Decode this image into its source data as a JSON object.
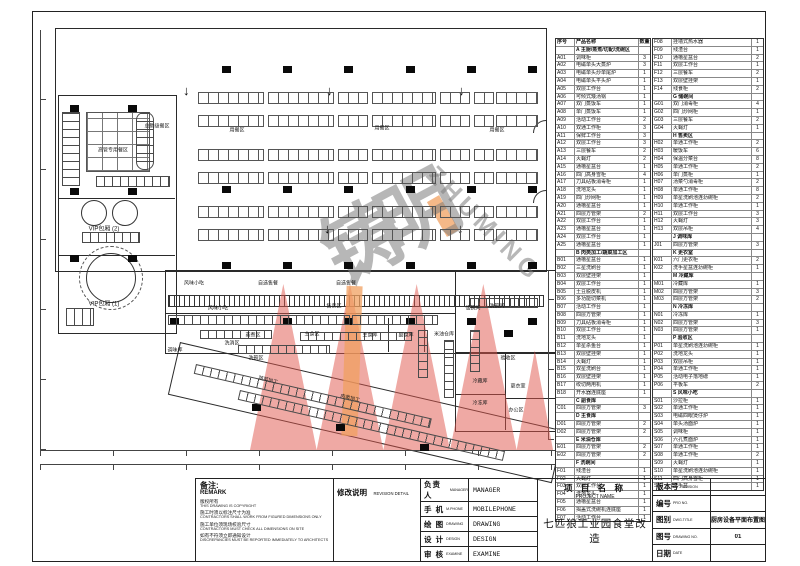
{
  "sheet": {
    "remark": {
      "title": "备注:",
      "subtitle": "REMARK",
      "lines": [
        [
          "版权所有",
          "THIS DRAWING IS COPYRIGHT"
        ],
        [
          "施工时须以标注尺寸为准",
          "CONTRACTORS SHALL WORK FROM FIGURED DIMENSIONS ONLY"
        ],
        [
          "施工单位须现场校验尺寸",
          "CONTRACTORS MUST CHECK ALL DIMENSIONS ON SITE"
        ],
        [
          "如有不符须立即通知设计",
          "DISCREPANCIES MUST BE REPORTED IMMEDIATELY TO ARCHITECTS"
        ]
      ]
    },
    "revision": {
      "label": "修改说明",
      "label_en": "REVISION DETAIL"
    },
    "signoff": [
      [
        "负责人",
        "MANAGER",
        "MANAGER"
      ],
      [
        "手 机",
        "M.PHONE",
        "MOBILEPHONE"
      ],
      [
        "绘 图",
        "DRAWING",
        "DRAWING"
      ],
      [
        "设 计",
        "DESIGN",
        "DESIGN"
      ],
      [
        "审 核",
        "EXAMINE",
        "EXAMINE"
      ]
    ],
    "project": {
      "label": "项 目 名 称",
      "label_en": "PROJECT NAME",
      "name": "七匹狼工业园食堂改造"
    },
    "info": [
      [
        "版本号",
        "REVISION",
        ""
      ],
      [
        "编号",
        "PRO NO.",
        ""
      ],
      [
        "图别",
        "DWG.TITLE",
        "厨房设备平面布置图"
      ],
      [
        "图号",
        "DRAWING NO.",
        "01"
      ],
      [
        "日期",
        "DATE",
        ""
      ]
    ]
  },
  "equipment": {
    "headers": [
      "序号",
      "产品名称",
      "数量"
    ],
    "left": [
      {
        "s": "A 主厨/蒸煮/切配/洗碗区"
      },
      [
        "A01",
        "调味柜",
        "3"
      ],
      [
        "A02",
        "电磁单头大蒸炉",
        "3"
      ],
      [
        "A03",
        "电磁单头炒单尾炉",
        "1"
      ],
      [
        "A04",
        "电磁单头平头炉",
        "1"
      ],
      [
        "A05",
        "双层工作台",
        "1"
      ],
      [
        "A06",
        "可倾式矮汤锅",
        "1"
      ],
      [
        "A07",
        "双门蒸饭车",
        "1"
      ],
      [
        "A08",
        "单门蒸饭车",
        "1"
      ],
      [
        "A09",
        "活动工作台",
        "2"
      ],
      [
        "A10",
        "双通工作柜",
        "3"
      ],
      [
        "A11",
        "保鲜工作台",
        "3"
      ],
      [
        "A12",
        "双层工作台",
        "3"
      ],
      [
        "A13",
        "三层餐车",
        "2"
      ],
      [
        "A14",
        "灭蝇灯",
        "2"
      ],
      [
        "A15",
        "通槽星盆台",
        "1"
      ],
      [
        "A16",
        "四门高身雪柜",
        "4"
      ],
      [
        "A17",
        "刀具砧板消毒柜",
        "1"
      ],
      [
        "A18",
        "洗地龙头",
        "1"
      ],
      [
        "A19",
        "四门炒网柜",
        "1"
      ],
      [
        "A20",
        "通槽星盆台",
        "1"
      ],
      [
        "A21",
        "四层方管架",
        "2"
      ],
      [
        "A22",
        "双层工作台",
        "1"
      ],
      [
        "A23",
        "通槽星盆台",
        "1"
      ],
      [
        "A24",
        "双层工作台",
        "1"
      ],
      [
        "A25",
        "通槽星盆台",
        "1"
      ],
      {
        "s": "B 肉类加工/蔬菜加工区"
      },
      [
        "B01",
        "通槽星盆台",
        "1"
      ],
      [
        "B02",
        "三星洗刷台",
        "1"
      ],
      [
        "B03",
        "双层壁挂架",
        "1"
      ],
      [
        "B04",
        "双层工作台",
        "1"
      ],
      [
        "B05",
        "土豆脱皮机",
        "1"
      ],
      [
        "B06",
        "多功能切菜机",
        "1"
      ],
      [
        "B07",
        "活动工作台",
        "1"
      ],
      [
        "B08",
        "四层方管架",
        "1"
      ],
      [
        "B09",
        "刀具砧板消毒柜",
        "1"
      ],
      [
        "B10",
        "双层工作台",
        "1"
      ],
      [
        "B11",
        "洗地龙头",
        "1"
      ],
      [
        "B12",
        "单星杀鱼台",
        "1"
      ],
      [
        "B13",
        "双层壁挂架",
        "1"
      ],
      [
        "B14",
        "灭蝇灯",
        "1"
      ],
      [
        "B15",
        "双星洗刷台",
        "1"
      ],
      [
        "B16",
        "双层壁挂架",
        "1"
      ],
      [
        "B17",
        "绞切两用机",
        "1"
      ],
      [
        "B18",
        "开水器连底座",
        "1"
      ],
      {
        "s": "C 副食库"
      },
      [
        "C01",
        "四层方管架",
        "3"
      ],
      {
        "s": "D 主食库"
      },
      [
        "D01",
        "四层方管架",
        "2"
      ],
      [
        "D02",
        "四层方管架",
        "2"
      ],
      {
        "s": "E 米油仓库"
      },
      [
        "E01",
        "四层方管架",
        "2"
      ],
      [
        "E02",
        "四层方管架",
        "2"
      ],
      {
        "s": "F 洗碗间"
      },
      [
        "F01",
        "残渣台",
        "1"
      ],
      [
        "F02",
        "灭蝇灯",
        "1"
      ],
      [
        "F03",
        "双层工作台",
        "1"
      ],
      [
        "F04",
        "洗地龙头",
        "1"
      ],
      [
        "F05",
        "通槽星盆台",
        "1"
      ],
      [
        "F06",
        "揭盖式洗碗机连底座",
        "1"
      ],
      [
        "F07",
        "活动工作台",
        "1"
      ]
    ],
    "right": [
      [
        "F08",
        "挂墙式热水器",
        "1"
      ],
      [
        "F09",
        "残渣台",
        "1"
      ],
      [
        "F10",
        "通槽星盆台",
        "2"
      ],
      [
        "F11",
        "双层工作台",
        "1"
      ],
      [
        "F12",
        "三层餐车",
        "2"
      ],
      [
        "F13",
        "双层壁挂架",
        "1"
      ],
      [
        "F14",
        "残食柜",
        "2"
      ],
      {
        "s": "G 储碗间"
      },
      [
        "G01",
        "双门消毒柜",
        "4"
      ],
      [
        "G02",
        "四门炒网柜",
        "1"
      ],
      [
        "G03",
        "三层餐车",
        "2"
      ],
      [
        "G04",
        "灭蝇灯",
        "1"
      ],
      {
        "s": "H 售卖区"
      },
      [
        "H02",
        "单通工作柜",
        "2"
      ],
      [
        "H03",
        "暖饭车",
        "6"
      ],
      [
        "H04",
        "保温分菜台",
        "8"
      ],
      [
        "H05",
        "单通工作柜",
        "2"
      ],
      [
        "H06",
        "单门蒸柜",
        "1"
      ],
      [
        "H07",
        "汤菜勺消毒柜",
        "2"
      ],
      [
        "H08",
        "单通工作柜",
        "8"
      ],
      [
        "H09",
        "单星洗刷池连沥碗柜",
        "2"
      ],
      [
        "H10",
        "单通工作柜",
        "1"
      ],
      [
        "H11",
        "双层工作台",
        "3"
      ],
      [
        "H12",
        "灭蝇灯",
        "3"
      ],
      [
        "H13",
        "双层吊柜",
        "4"
      ],
      {
        "s": "J 调味库"
      },
      [
        "J01",
        "四层方管架",
        "3"
      ],
      {
        "s": "K 更衣室"
      },
      [
        "K01",
        "六门更衣柜",
        "2"
      ],
      [
        "K02",
        "洗手星盆连沥碗柜",
        "1"
      ],
      {
        "s": "M 冷藏库"
      },
      [
        "M01",
        "冷藏库",
        "1"
      ],
      [
        "M02",
        "四层方管架",
        "3"
      ],
      [
        "M03",
        "四层方管架",
        "2"
      ],
      {
        "s": "N 冷冻库"
      },
      [
        "N01",
        "冷冻库",
        "1"
      ],
      [
        "N02",
        "四层方管架",
        "3"
      ],
      [
        "N03",
        "四层方管架",
        "1"
      ],
      {
        "s": "P 验收区"
      },
      [
        "P01",
        "单星洗刷池连沥碗柜",
        "1"
      ],
      [
        "P02",
        "洗地龙头",
        "1"
      ],
      [
        "P03",
        "双层吊柜",
        "1"
      ],
      [
        "P04",
        "单通工作柜",
        "1"
      ],
      [
        "P05",
        "活动电子落地磅",
        "1"
      ],
      [
        "P06",
        "平板车",
        "2"
      ],
      {
        "s": "S 风味小吃"
      },
      [
        "S01",
        "沙拉柜",
        "1"
      ],
      [
        "S02",
        "单通工作柜",
        "1"
      ],
      [
        "S03",
        "电磁四眼煲仔炉",
        "1"
      ],
      [
        "S04",
        "单头汤面炉",
        "1"
      ],
      [
        "S05",
        "调味柜",
        "1"
      ],
      [
        "S06",
        "六孔煮面炉",
        "1"
      ],
      [
        "S07",
        "单通工作柜",
        "1"
      ],
      [
        "S08",
        "单通工作柜",
        "2"
      ],
      [
        "S09",
        "灭蝇灯",
        "1"
      ],
      [
        "S10",
        "单星洗刷池连沥碗柜",
        "1"
      ],
      [
        "S11",
        "四门高身雪柜",
        "1"
      ],
      [
        "S12",
        "洗手盆",
        "1"
      ]
    ]
  },
  "plan": {
    "arrow_glyph": "↓",
    "labels": [
      {
        "t": "用餐区",
        "x": 237,
        "y": 131
      },
      {
        "t": "用餐区",
        "x": 382,
        "y": 129
      },
      {
        "t": "用餐区",
        "x": 497,
        "y": 131
      },
      {
        "t": "总助级餐区",
        "x": 157,
        "y": 127
      },
      {
        "t": "高管专用餐区",
        "x": 113,
        "y": 151
      },
      {
        "t": "VIP包厢 (2)",
        "x": 104,
        "y": 230,
        "fs": 6
      },
      {
        "t": "VIP包厢 (1)",
        "x": 104,
        "y": 305,
        "fs": 6
      },
      {
        "t": "风味小吃",
        "x": 194,
        "y": 284
      },
      {
        "t": "自选售餐",
        "x": 268,
        "y": 284
      },
      {
        "t": "自选售餐",
        "x": 346,
        "y": 284
      },
      {
        "t": "风味小吃",
        "x": 218,
        "y": 309
      },
      {
        "t": "售卖区",
        "x": 334,
        "y": 307
      },
      {
        "t": "蒸煮区",
        "x": 253,
        "y": 336
      },
      {
        "t": "主食区",
        "x": 312,
        "y": 335
      },
      {
        "t": "洗消区",
        "x": 232,
        "y": 344
      },
      {
        "t": "洗碗区",
        "x": 256,
        "y": 359
      },
      {
        "t": "调味库",
        "x": 175,
        "y": 351
      },
      {
        "t": "蔬菜加工",
        "x": 268,
        "y": 381,
        "r": 13
      },
      {
        "t": "肉类加工",
        "x": 350,
        "y": 399,
        "r": 13
      },
      {
        "t": "主食库",
        "x": 370,
        "y": 336
      },
      {
        "t": "副食库",
        "x": 406,
        "y": 336
      },
      {
        "t": "米油仓库",
        "x": 444,
        "y": 335
      },
      {
        "t": "储碗间",
        "x": 473,
        "y": 309
      },
      {
        "t": "洗碗间",
        "x": 497,
        "y": 307
      },
      {
        "t": "验收区",
        "x": 508,
        "y": 359
      },
      {
        "t": "冷藏库",
        "x": 480,
        "y": 382
      },
      {
        "t": "冷冻库",
        "x": 480,
        "y": 404
      },
      {
        "t": "更衣室",
        "x": 518,
        "y": 387
      },
      {
        "t": "办公区",
        "x": 516,
        "y": 411
      }
    ],
    "columns": [
      [
        70,
        105
      ],
      [
        128,
        105
      ],
      [
        70,
        188
      ],
      [
        128,
        188
      ],
      [
        70,
        255
      ],
      [
        128,
        255
      ],
      [
        222,
        66
      ],
      [
        283,
        66
      ],
      [
        344,
        66
      ],
      [
        406,
        66
      ],
      [
        467,
        66
      ],
      [
        528,
        66
      ],
      [
        222,
        186
      ],
      [
        283,
        186
      ],
      [
        344,
        186
      ],
      [
        406,
        186
      ],
      [
        467,
        186
      ],
      [
        528,
        186
      ],
      [
        222,
        262
      ],
      [
        283,
        262
      ],
      [
        344,
        262
      ],
      [
        406,
        262
      ],
      [
        467,
        262
      ],
      [
        528,
        262
      ],
      [
        170,
        318
      ],
      [
        283,
        318
      ],
      [
        344,
        318
      ],
      [
        406,
        318
      ],
      [
        467,
        318
      ],
      [
        528,
        318
      ],
      [
        252,
        404
      ],
      [
        336,
        424
      ],
      [
        420,
        444
      ],
      [
        504,
        330
      ]
    ],
    "arrows": [
      [
        183,
        86
      ],
      [
        326,
        86
      ],
      [
        458,
        86
      ],
      [
        324,
        224
      ],
      [
        457,
        224
      ]
    ],
    "dining": {
      "ys": [
        92,
        115,
        149,
        172,
        206,
        229
      ],
      "segments": [
        [
          198,
          64
        ],
        [
          268,
          64
        ],
        [
          338,
          28
        ],
        [
          372,
          62
        ],
        [
          440,
          28
        ],
        [
          474,
          18
        ],
        [
          496,
          40
        ]
      ]
    },
    "strips": [
      [
        168,
        315,
        180,
        8,
        0
      ],
      [
        352,
        315,
        84,
        8,
        0
      ],
      [
        200,
        330,
        70,
        7,
        0
      ],
      [
        238,
        345,
        90,
        7,
        0
      ],
      [
        300,
        332,
        110,
        7,
        0
      ],
      [
        418,
        330,
        8,
        46,
        0
      ],
      [
        444,
        340,
        8,
        56,
        0
      ],
      [
        470,
        298,
        66,
        8,
        0
      ],
      [
        470,
        330,
        8,
        40,
        0
      ],
      [
        196,
        364,
        240,
        8,
        13
      ],
      [
        240,
        390,
        270,
        8,
        13
      ],
      [
        62,
        112,
        16,
        72,
        0
      ],
      [
        96,
        176,
        72,
        9,
        0
      ],
      [
        82,
        232,
        56,
        9,
        0
      ],
      [
        66,
        308,
        26,
        16,
        0
      ]
    ],
    "watermark": {
      "cn": "铸明",
      "en": "ZHUMING",
      "gray": "#7d7d7d",
      "red": "#e0544a",
      "orange": "#f0a060"
    }
  }
}
